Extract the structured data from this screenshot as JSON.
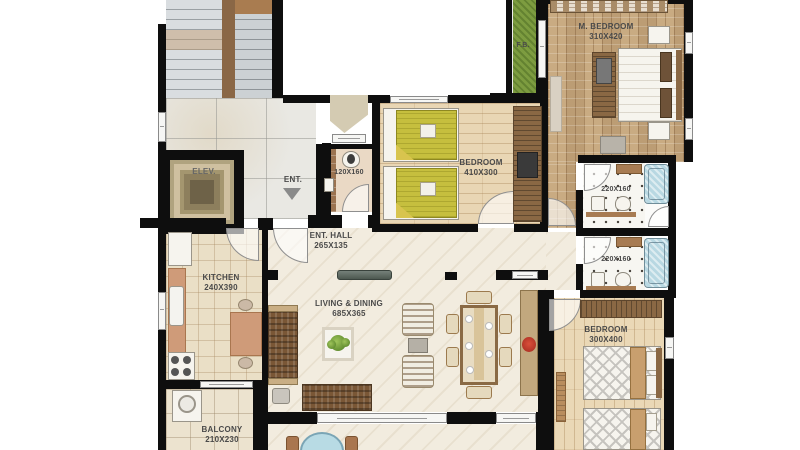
{
  "plan_title": "apartment floor plan",
  "labels": {
    "elevator": "ELEV.",
    "entrance": "ENT.",
    "flower_bed": "F.B.",
    "toilet_dims": "120X160",
    "bath1_dims": "220X160",
    "bath2_dims": "220X160",
    "m_bedroom": {
      "name": "M. BEDROOM",
      "dims": "310X420"
    },
    "bedroom1": {
      "name": "BEDROOM",
      "dims": "410X300"
    },
    "bedroom2": {
      "name": "BEDROOM",
      "dims": "300X400"
    },
    "ent_hall": {
      "name": "ENT. HALL",
      "dims": "265X135"
    },
    "kitchen": {
      "name": "KITCHEN",
      "dims": "240X390"
    },
    "living": {
      "name": "LIVING & DINING",
      "dims": "685X365"
    },
    "balcony": {
      "name": "BALCONY",
      "dims": "210X230"
    }
  },
  "colors": {
    "wall": "#0e0e0e",
    "grass": "#7d9c40",
    "bathtub": "#b8d8e2",
    "bed_blanket_yellow": "#c6bf3e",
    "sofa_brown": "#7a5736",
    "kitchen_counter": "#cf9b79",
    "parquet": "#c9ab82",
    "marble": "#f2ecdf",
    "label_text": "#4a4a4a"
  }
}
